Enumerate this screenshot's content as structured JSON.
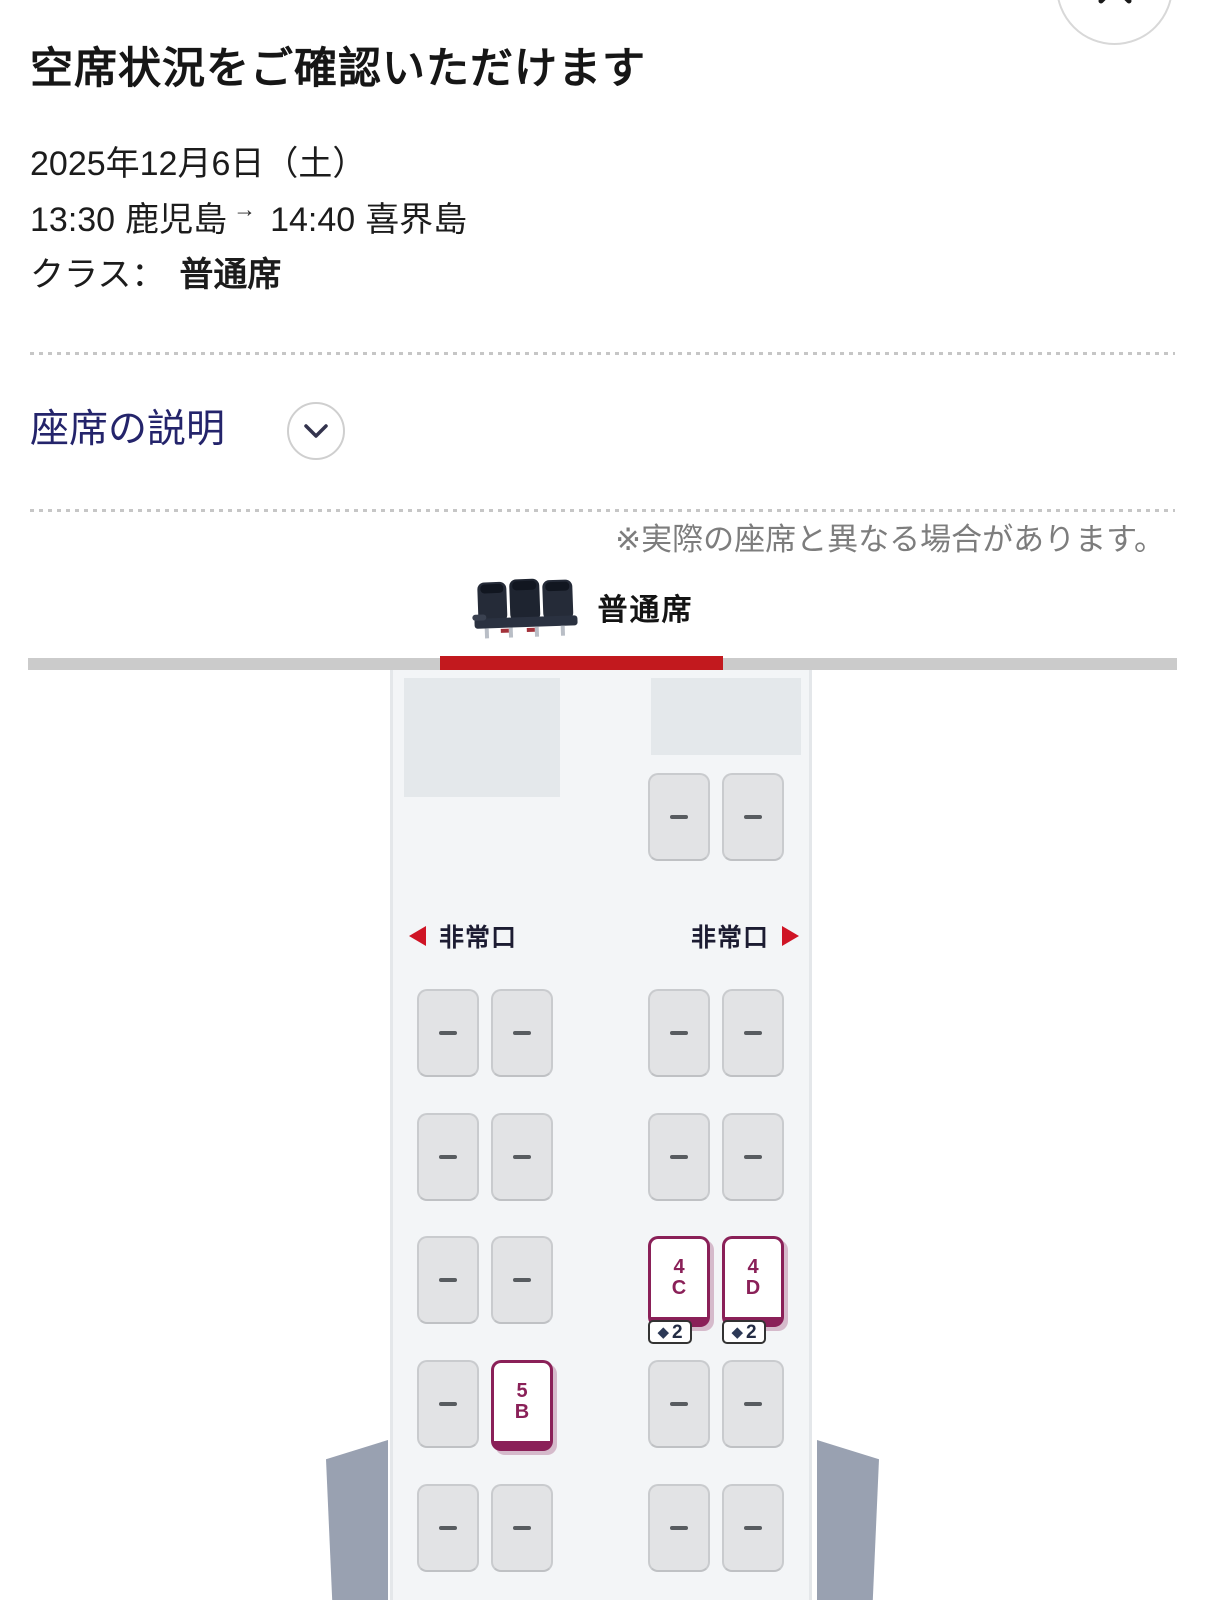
{
  "header": {
    "title": "空席状況をご確認いただけます",
    "date": "2025年12月6日（土）",
    "route": {
      "departure_time": "13:30",
      "departure_city": "鹿児島",
      "arrow": "→",
      "arrival_time": "14:40",
      "arrival_city": "喜界島"
    },
    "class_label": "クラス：",
    "class_value": "普通席"
  },
  "seat_legend": {
    "label": "座席の説明"
  },
  "disclaimer": "※実際の座席と異なる場合があります。",
  "tab": {
    "label": "普通席"
  },
  "seat_map": {
    "exit_label_left": "非常口",
    "exit_label_right": "非常口",
    "badge_icon": "◆",
    "rows": [
      {
        "seats": [
          {
            "id": "1C",
            "state": "unavailable"
          },
          {
            "id": "1D",
            "state": "unavailable"
          }
        ]
      },
      {
        "seats": [
          {
            "id": "2A",
            "state": "unavailable"
          },
          {
            "id": "2B",
            "state": "unavailable"
          },
          {
            "id": "2C",
            "state": "unavailable"
          },
          {
            "id": "2D",
            "state": "unavailable"
          }
        ]
      },
      {
        "seats": [
          {
            "id": "3A",
            "state": "unavailable"
          },
          {
            "id": "3B",
            "state": "unavailable"
          },
          {
            "id": "3C",
            "state": "unavailable"
          },
          {
            "id": "3D",
            "state": "unavailable"
          }
        ]
      },
      {
        "seats": [
          {
            "id": "4A",
            "state": "unavailable"
          },
          {
            "id": "4B",
            "state": "unavailable"
          },
          {
            "id": "4C",
            "state": "available",
            "num": "4",
            "letter": "C",
            "badge_count": "2"
          },
          {
            "id": "4D",
            "state": "available",
            "num": "4",
            "letter": "D",
            "badge_count": "2"
          }
        ]
      },
      {
        "seats": [
          {
            "id": "5A",
            "state": "unavailable"
          },
          {
            "id": "5B",
            "state": "available",
            "num": "5",
            "letter": "B"
          },
          {
            "id": "5C",
            "state": "unavailable"
          },
          {
            "id": "5D",
            "state": "unavailable"
          }
        ]
      },
      {
        "seats": [
          {
            "id": "6A",
            "state": "unavailable"
          },
          {
            "id": "6B",
            "state": "unavailable"
          },
          {
            "id": "6C",
            "state": "unavailable"
          },
          {
            "id": "6D",
            "state": "unavailable"
          }
        ]
      }
    ]
  },
  "colors": {
    "brand_red": "#c2191e",
    "available_seat_maroon": "#8a2058",
    "badge_navy": "#2c3956",
    "exit_red": "#cf1425",
    "legend_navy": "#24246b",
    "wing_gray": "#99a1b1"
  }
}
